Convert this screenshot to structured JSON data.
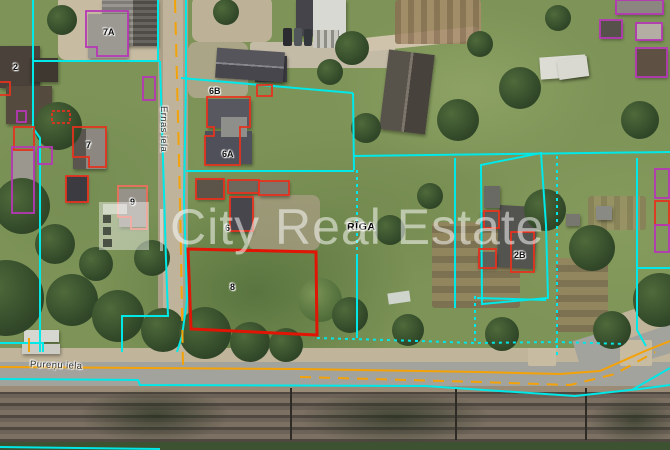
{
  "map": {
    "city_label": "RĪGA",
    "streets": {
      "vertical_street": "Ernas iela",
      "bottom_street": "Pureņu iela"
    },
    "parcel_labels": [
      {
        "text": "2"
      },
      {
        "text": "7A"
      },
      {
        "text": "7"
      },
      {
        "text": "6B"
      },
      {
        "text": "6A"
      },
      {
        "text": "9"
      },
      {
        "text": "6"
      },
      {
        "text": "8"
      },
      {
        "text": "2B"
      }
    ],
    "colors": {
      "parcel_boundary_cyan": "#00e8e8",
      "building_outline_red": "#e5321e",
      "featured_parcel_red": "#e01505",
      "building_outline_purple": "#b637b6",
      "road_line_orange": "#f3a208"
    }
  },
  "watermark": {
    "text": "City Real Estate"
  }
}
